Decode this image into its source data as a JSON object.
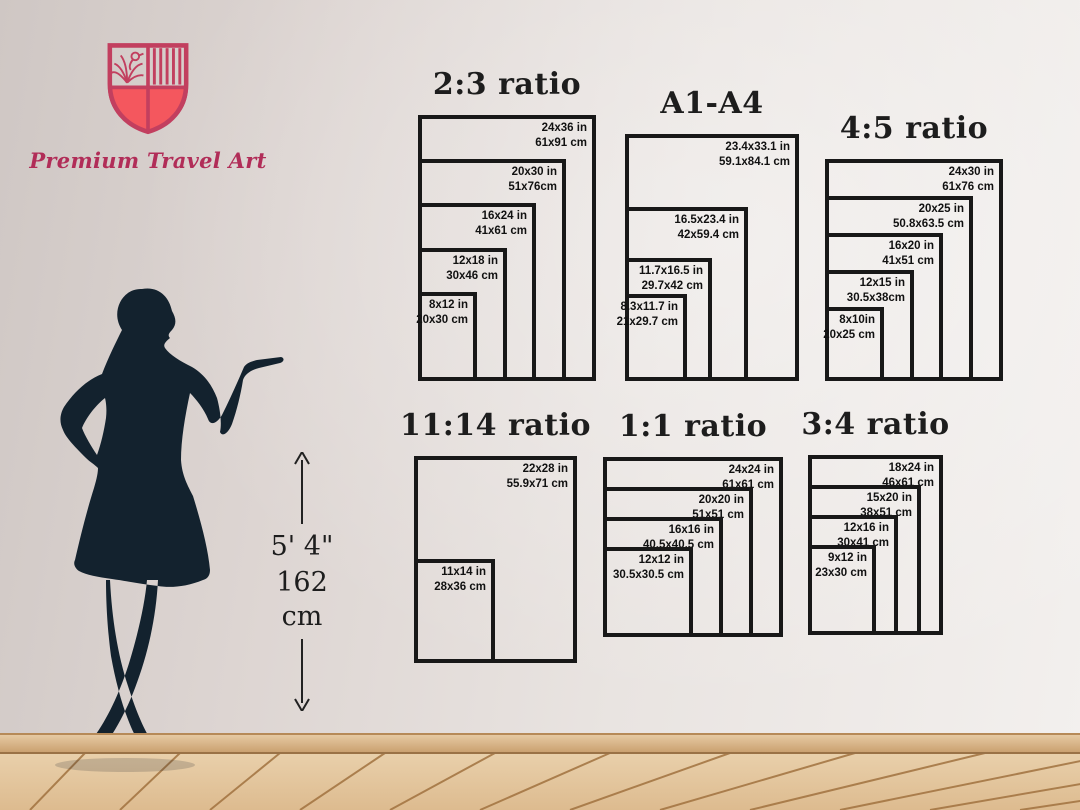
{
  "brand": {
    "name": "Premium Travel Art"
  },
  "height_marker": {
    "imperial": "5' 4\"",
    "metric": "162 cm"
  },
  "colors": {
    "frame": "#181818",
    "brand_pink": "#b12d58",
    "shield_outline": "#c23f5f",
    "shield_fill": "#f4575e",
    "silhouette": "#13222e",
    "floor_wood": "#e2c49e",
    "floor_seam": "#a1723f"
  },
  "charts": [
    {
      "id": "ratio-2-3",
      "title": "2:3 ratio",
      "sizes": [
        {
          "label_in": "24x36 in",
          "label_cm": "61x91 cm",
          "w": 24,
          "h": 36
        },
        {
          "label_in": "20x30 in",
          "label_cm": "51x76cm",
          "w": 20,
          "h": 30
        },
        {
          "label_in": "16x24 in",
          "label_cm": "41x61 cm",
          "w": 16,
          "h": 24
        },
        {
          "label_in": "12x18 in",
          "label_cm": "30x46 cm",
          "w": 12,
          "h": 18
        },
        {
          "label_in": "8x12 in",
          "label_cm": "20x30 cm",
          "w": 8,
          "h": 12
        }
      ]
    },
    {
      "id": "a1-a4",
      "title": "A1-A4",
      "sizes": [
        {
          "label_in": "23.4x33.1 in",
          "label_cm": "59.1x84.1 cm",
          "w": 23.4,
          "h": 33.1
        },
        {
          "label_in": "16.5x23.4 in",
          "label_cm": "42x59.4 cm",
          "w": 16.5,
          "h": 23.4
        },
        {
          "label_in": "11.7x16.5 in",
          "label_cm": "29.7x42 cm",
          "w": 11.7,
          "h": 16.5
        },
        {
          "label_in": "8.3x11.7 in",
          "label_cm": "21x29.7 cm",
          "w": 8.3,
          "h": 11.7
        }
      ]
    },
    {
      "id": "ratio-4-5",
      "title": "4:5 ratio",
      "sizes": [
        {
          "label_in": "24x30 in",
          "label_cm": "61x76 cm",
          "w": 24,
          "h": 30
        },
        {
          "label_in": "20x25 in",
          "label_cm": "50.8x63.5 cm",
          "w": 20,
          "h": 25
        },
        {
          "label_in": "16x20 in",
          "label_cm": "41x51 cm",
          "w": 16,
          "h": 20
        },
        {
          "label_in": "12x15 in",
          "label_cm": "30.5x38cm",
          "w": 12,
          "h": 15
        },
        {
          "label_in": "8x10in",
          "label_cm": "20x25 cm",
          "w": 8,
          "h": 10
        }
      ]
    },
    {
      "id": "ratio-11-14",
      "title": "11:14 ratio",
      "sizes": [
        {
          "label_in": "22x28 in",
          "label_cm": "55.9x71 cm",
          "w": 22,
          "h": 28
        },
        {
          "label_in": "11x14 in",
          "label_cm": "28x36 cm",
          "w": 11,
          "h": 14
        }
      ]
    },
    {
      "id": "ratio-1-1",
      "title": "1:1 ratio",
      "sizes": [
        {
          "label_in": "24x24 in",
          "label_cm": "61x61 cm",
          "w": 24,
          "h": 24
        },
        {
          "label_in": "20x20 in",
          "label_cm": "51x51 cm",
          "w": 20,
          "h": 20
        },
        {
          "label_in": "16x16 in",
          "label_cm": "40.5x40.5 cm",
          "w": 16,
          "h": 16
        },
        {
          "label_in": "12x12 in",
          "label_cm": "30.5x30.5 cm",
          "w": 12,
          "h": 12
        }
      ]
    },
    {
      "id": "ratio-3-4",
      "title": "3:4 ratio",
      "sizes": [
        {
          "label_in": "18x24 in",
          "label_cm": "46x61 cm",
          "w": 18,
          "h": 24
        },
        {
          "label_in": "15x20 in",
          "label_cm": "38x51 cm",
          "w": 15,
          "h": 20
        },
        {
          "label_in": "12x16 in",
          "label_cm": "30x41 cm",
          "w": 12,
          "h": 16
        },
        {
          "label_in": "9x12 in",
          "label_cm": "23x30 cm",
          "w": 9,
          "h": 12
        }
      ]
    }
  ]
}
